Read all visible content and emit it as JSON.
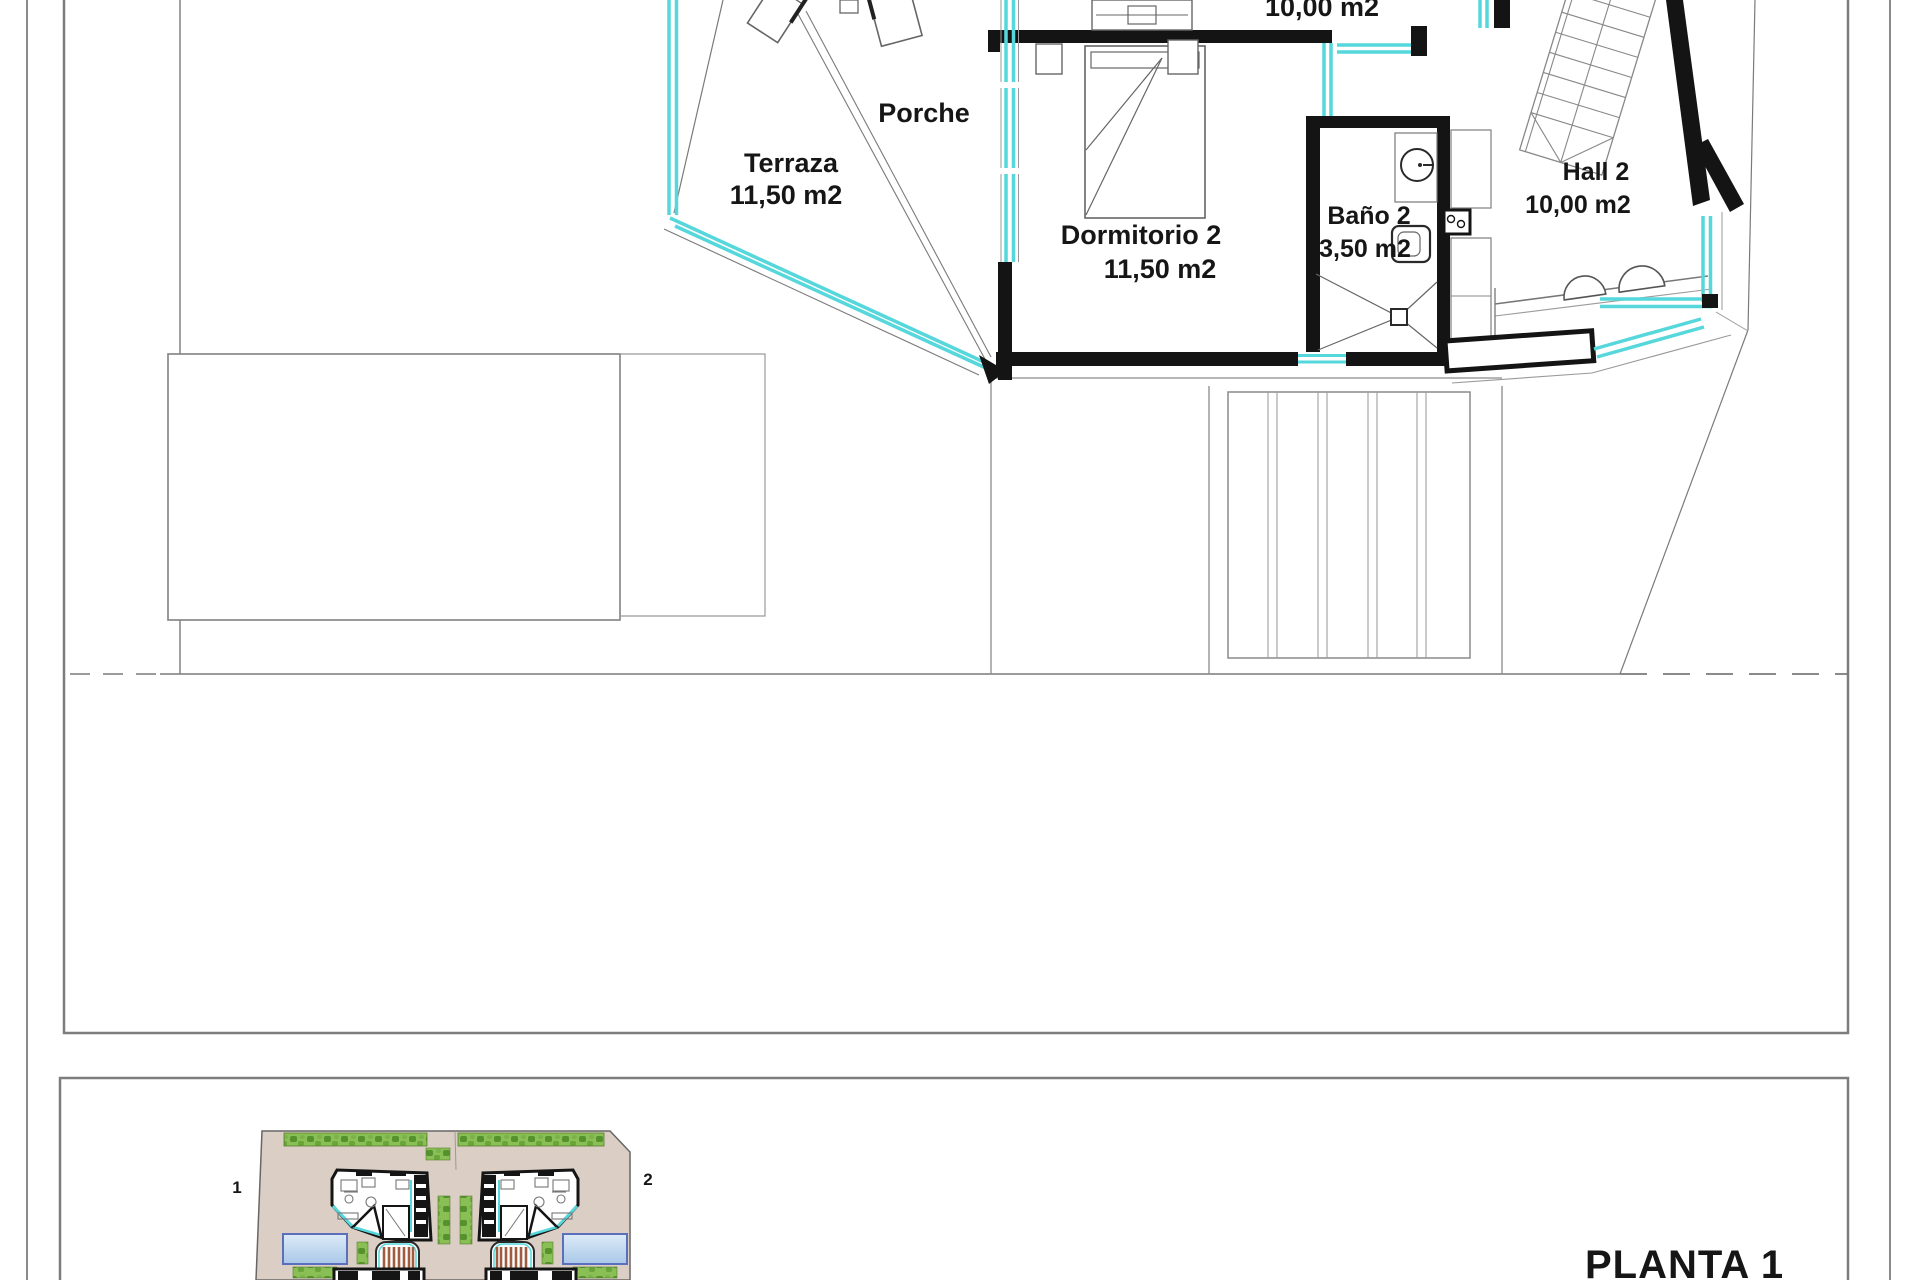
{
  "drawing": {
    "plan_title": "PLANTA 1",
    "rooms": {
      "upper_partial": {
        "area": "10,00 m2"
      },
      "porche": {
        "label": "Porche"
      },
      "terraza": {
        "label": "Terraza",
        "area": "11,50 m2"
      },
      "dormitorio2": {
        "label": "Dormitorio 2",
        "area": "11,50 m2"
      },
      "bano2": {
        "label": "Baño 2",
        "area": "3,50 m2"
      },
      "hall2": {
        "label": "Hall 2",
        "area": "10,00 m2"
      }
    },
    "site_plan": {
      "villa1_label": "1",
      "villa2_label": "2"
    },
    "colors": {
      "glazing_cyan": "#56d7dc",
      "wall_black": "#141414",
      "line_gray": "#7a7a7a",
      "site_ground_tan": "#dbcfc5",
      "hedge_green": "#8abf55",
      "hedge_green_dark": "#55922e",
      "pool_border_blue": "#5b6fbd",
      "pool_fill_blue": "#c3d9ee",
      "stair_tread_brown": "#a05c3e"
    }
  }
}
